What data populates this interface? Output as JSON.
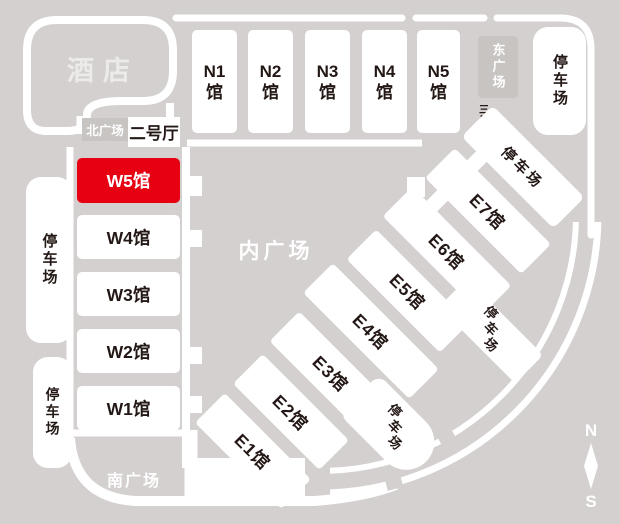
{
  "title": "exhibition-center-venue-map",
  "hotel": {
    "label": "酒店"
  },
  "plazas": {
    "north": "北广场",
    "east": "东广场",
    "south": "南广场",
    "inner": "内广场"
  },
  "halls_entrances": {
    "hall2": "二号厅",
    "hall3": "三号厅"
  },
  "north_halls": [
    {
      "top": "N1",
      "bottom": "馆"
    },
    {
      "top": "N2",
      "bottom": "馆"
    },
    {
      "top": "N3",
      "bottom": "馆"
    },
    {
      "top": "N4",
      "bottom": "馆"
    },
    {
      "top": "N5",
      "bottom": "馆"
    }
  ],
  "west_halls": [
    {
      "label": "W5馆",
      "highlight": true
    },
    {
      "label": "W4馆",
      "highlight": false
    },
    {
      "label": "W3馆",
      "highlight": false
    },
    {
      "label": "W2馆",
      "highlight": false
    },
    {
      "label": "W1馆",
      "highlight": false
    }
  ],
  "east_halls": [
    {
      "label": "E1馆"
    },
    {
      "label": "E2馆"
    },
    {
      "label": "E3馆"
    },
    {
      "label": "E4馆"
    },
    {
      "label": "E5馆"
    },
    {
      "label": "E6馆"
    },
    {
      "label": "E7馆"
    }
  ],
  "parking": {
    "label": "停车场",
    "chars": [
      "停",
      "车",
      "场"
    ]
  },
  "compass": {
    "north": "N",
    "south": "S"
  },
  "colors": {
    "background": "#d3d0cf",
    "plaza_box": "#c8c4c2",
    "highlight_red": "#e60012",
    "ink": "#231815",
    "white": "#ffffff"
  }
}
